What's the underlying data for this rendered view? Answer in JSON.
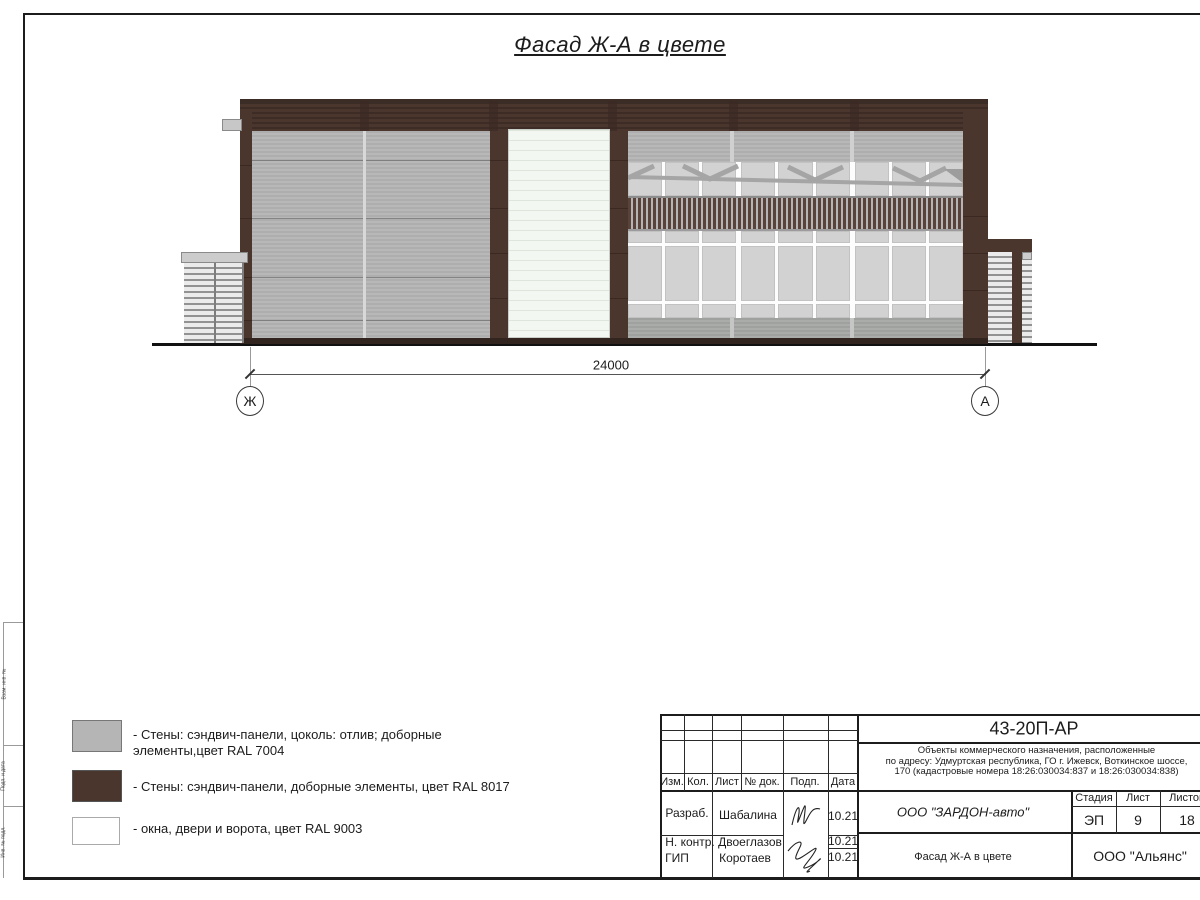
{
  "sheet": {
    "title": "Фасад Ж-А в цвете"
  },
  "drawing": {
    "dimension": "24000",
    "axes": {
      "left": "Ж",
      "right": "А"
    }
  },
  "colors": {
    "ral7004": "#b5b5b5",
    "ral8017": "#4b362e",
    "ral9003": "#ffffff",
    "glass": "#d2d2d2",
    "gateWhite": "#f3f7f1"
  },
  "legend": {
    "items": [
      {
        "color_name": "RAL 7004",
        "lines": [
          "- Стены: сэндвич-панели, цоколь: отлив; доборные",
          "элементы,цвет RAL 7004"
        ]
      },
      {
        "color_name": "RAL 8017",
        "lines": [
          "- Стены: сэндвич-панели, доборные элементы, цвет RAL 8017"
        ]
      },
      {
        "color_name": "RAL 9003",
        "lines": [
          "- окна, двери и ворота, цвет RAL 9003"
        ]
      }
    ]
  },
  "title_block": {
    "doc_code": "43-20П-АР",
    "project": [
      "Объекты коммерческого назначения, расположенные",
      "по адресу: Удмуртская республика, ГО г. Ижевск, Воткинское шоссе,",
      "170 (кадастровые номера 18:26:030034:837 и 18:26:030034:838)"
    ],
    "columns": {
      "izm": "Изм.",
      "kol": "Кол.",
      "list": "Лист",
      "doc": "№ док.",
      "podp": "Подп.",
      "data": "Дата"
    },
    "signers": [
      {
        "role": "Разраб.",
        "name": "Шабалина",
        "date": "10.21"
      },
      {
        "role": "Н. контр.",
        "name": "Двоеглазов",
        "date": "10.21"
      },
      {
        "role": "ГИП",
        "name": "Коротаев",
        "date": "10.21"
      }
    ],
    "company": "ООО \"ЗАРДОН-авто\"",
    "stage_label": "Стадия",
    "sheet_label": "Лист",
    "sheets_label": "Листов",
    "stage": "ЭП",
    "sheet_num": "9",
    "sheets_total": "18",
    "drawing_title": "Фасад Ж-А в цвете",
    "org": "ООО \"Альянс\""
  },
  "margin_labels": [
    "Взам. инв. №",
    "Подп. и дата",
    "Инв. № подл."
  ]
}
